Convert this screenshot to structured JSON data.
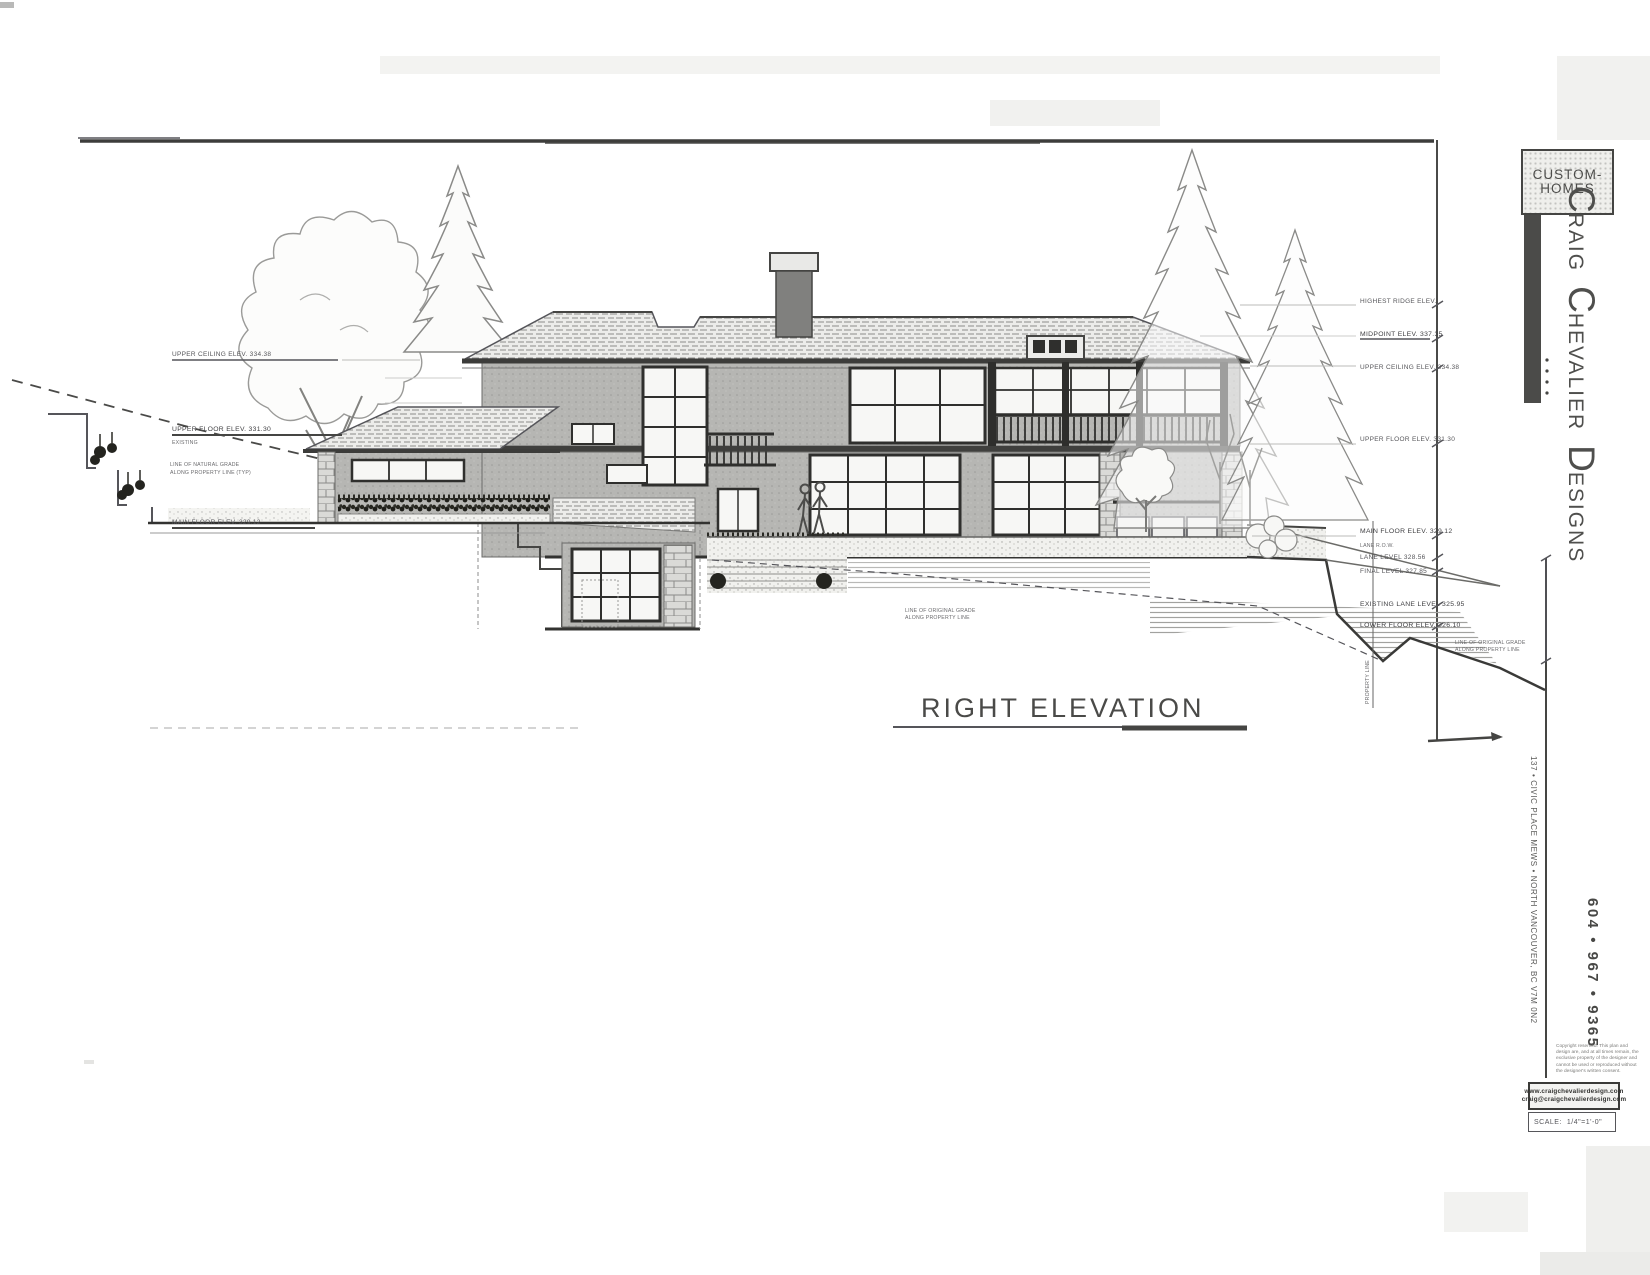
{
  "sheet": {
    "drawing_title": "RIGHT ELEVATION",
    "annotations": {
      "left_upper_ceiling": "UPPER CEILING ELEV.   334.38",
      "left_upper_floor": "UPPER FLOOR ELEV.   331.30",
      "left_existing": "EXISTING",
      "left_natural_grade_1": "LINE OF NATURAL GRADE",
      "left_natural_grade_2": "ALONG PROPERTY LINE  (TYP)",
      "left_main_floor": "MAIN FLOOR ELEV.   329.12",
      "right_highest_ridge": "HIGHEST RIDGE ELEV.",
      "right_midpoint": "MIDPOINT ELEV.   337.35",
      "right_upper_ceiling": "UPPER CEILING ELEV.   334.38",
      "right_upper_floor": "UPPER FLOOR ELEV.   331.30",
      "right_main_floor": "MAIN FLOOR ELEV.   329.12",
      "right_lane_row": "LANE R.O.W.",
      "right_lane_level": "LANE LEVEL   328.56",
      "right_final_level": "FINAL LEVEL   327.85",
      "right_existing_lane_level": "EXISTING LANE LEVEL   325.95",
      "right_lower_floor": "LOWER FLOOR ELEV.   326.10",
      "right_original_grade_1": "LINE OF ORIGINAL GRADE",
      "right_original_grade_2": "ALONG PROPERTY LINE",
      "center_original_grade_1": "LINE OF ORIGINAL GRADE",
      "center_original_grade_2": "ALONG PROPERTY LINE",
      "property_line_vertical": "PROPERTY LINE"
    }
  },
  "title_block": {
    "logo_line1": "CUSTOM-",
    "logo_line2": "HOMES",
    "firm": {
      "initial1": "C",
      "rest1": "RAIG",
      "initial2": "C",
      "rest2": "HEVALIER",
      "initial3": "D",
      "rest3": "ESIGNS"
    },
    "address_vertical": "137 • CIVIC PLACE MEWS • NORTH VANCOUVER, BC   V7M 0N2",
    "phone_vertical": "604 • 967 • 9365",
    "copyright_fine_print": "Copyright reserved. This plan and design are, and at all times remain, the exclusive property of the designer and cannot be used or reproduced without the designer's written consent.",
    "website_line1": "www.craigchevalierdesign.com",
    "website_line2": "craig@craigchevalierdesign.com",
    "scale_label": "SCALE:",
    "scale_value": "1/4\"=1'-0\""
  }
}
